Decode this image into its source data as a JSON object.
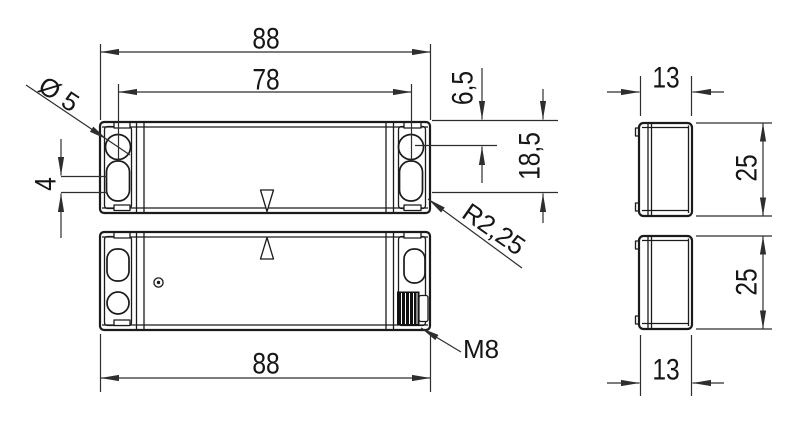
{
  "drawing_type": "technical-dimension-drawing",
  "colors": {
    "object_line": "#1b1b1b",
    "dimension_line": "#2e2e2e",
    "background": "#ffffff"
  },
  "dimensions": {
    "overall_width_top": "88",
    "mounting_hole_spacing": "78",
    "mounting_hole_diameter": "Ø 5",
    "slot_straight_length": "4",
    "top_edge_to_hole_center": "6,5",
    "top_edge_to_slot_end": "18,5",
    "slot_corner_radius": "R2,25",
    "cable_connector_thread": "M8",
    "overall_width_bottom": "88",
    "side_depth_top": "13",
    "side_height_top": "25",
    "side_height_bottom": "25",
    "side_depth_bottom": "13"
  }
}
